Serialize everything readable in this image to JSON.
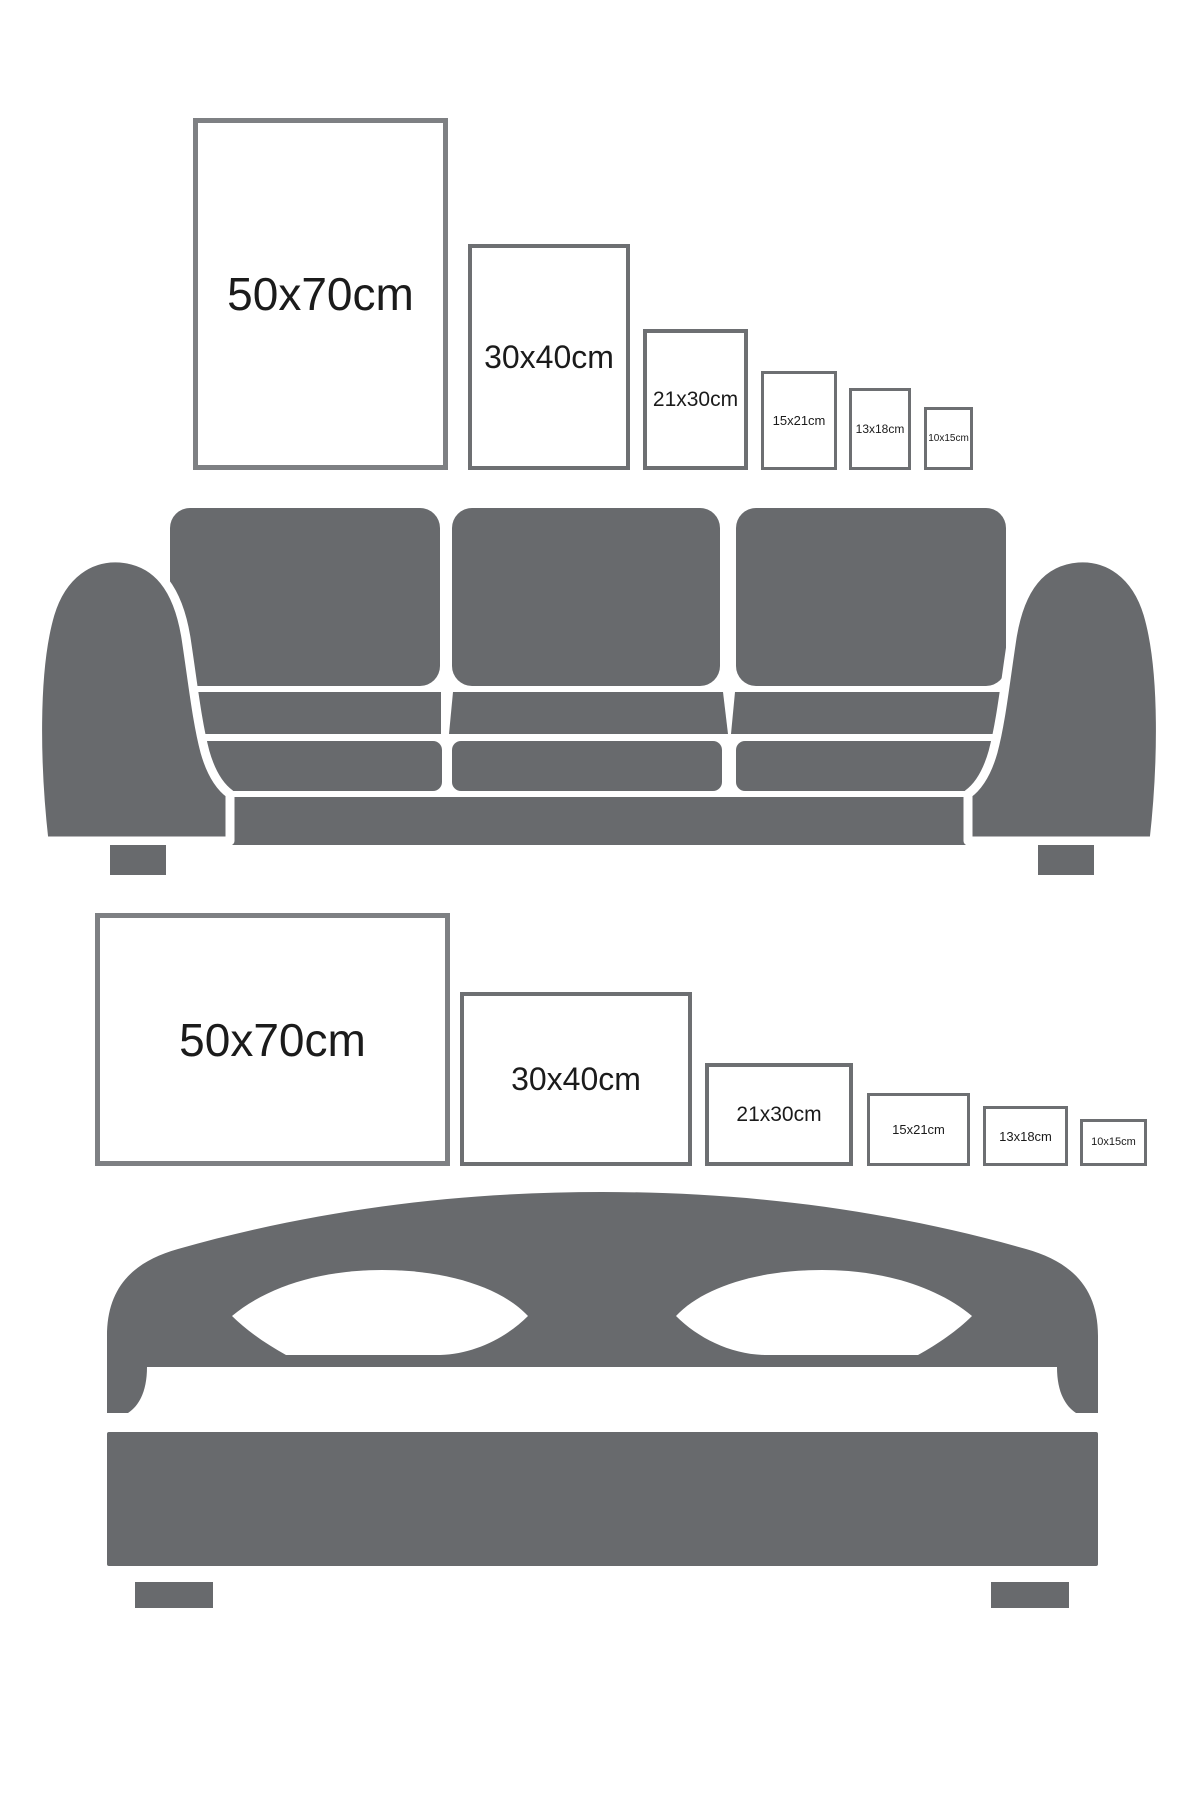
{
  "colors": {
    "background": "#ffffff",
    "furniture_gray": "#686a6d",
    "frame_border_large": "#7e8083",
    "frame_border_small": "#6d6f72",
    "label_text": "#1b1b1b",
    "pillow_cutout": "#ffffff"
  },
  "portrait_row": {
    "orientation": "portrait",
    "frames": [
      {
        "label": "50x70cm"
      },
      {
        "label": "30x40cm"
      },
      {
        "label": "21x30cm"
      },
      {
        "label": "15x21cm"
      },
      {
        "label": "13x18cm"
      },
      {
        "label": "10x15cm"
      }
    ]
  },
  "landscape_row": {
    "orientation": "landscape",
    "frames": [
      {
        "label": "50x70cm"
      },
      {
        "label": "30x40cm"
      },
      {
        "label": "21x30cm"
      },
      {
        "label": "15x21cm"
      },
      {
        "label": "13x18cm"
      },
      {
        "label": "10x15cm"
      }
    ]
  },
  "illustrations": {
    "sofa": "sofa-silhouette",
    "bed": "bed-silhouette"
  }
}
